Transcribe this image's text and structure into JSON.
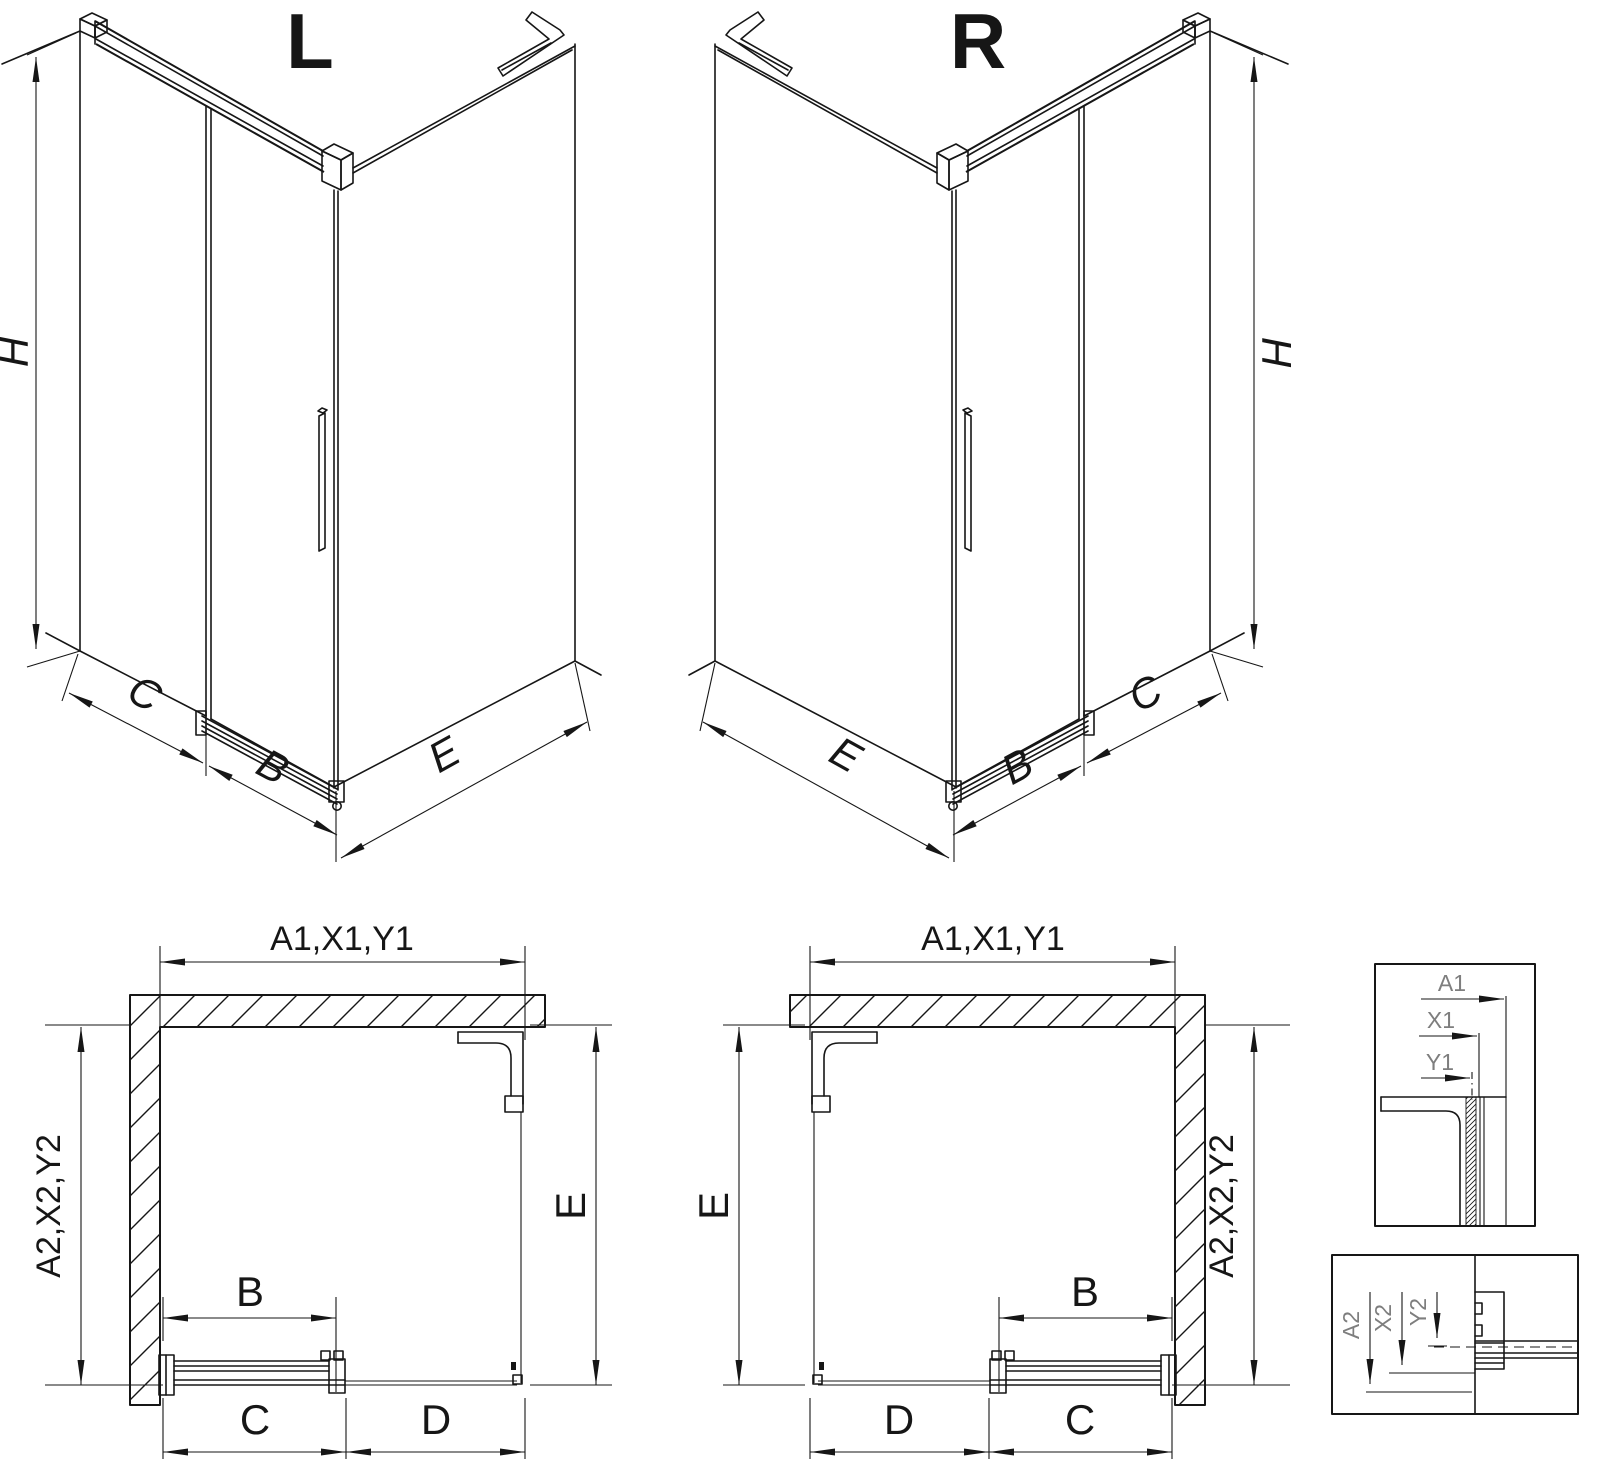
{
  "drawing": {
    "iso_left": {
      "title": "L",
      "height": "H",
      "segment_back": "C",
      "segment_door": "B",
      "segment_side": "E"
    },
    "iso_right": {
      "title": "R",
      "height": "H",
      "segment_back": "C",
      "segment_door": "B",
      "segment_side": "E"
    },
    "plan_left": {
      "width": "A1,X1,Y1",
      "depth": "A2,X2,Y2",
      "side": "E",
      "door": "B",
      "run": "C",
      "opening": "D"
    },
    "plan_right": {
      "width": "A1,X1,Y1",
      "depth": "A2,X2,Y2",
      "side": "E",
      "door": "B",
      "run": "C",
      "opening": "D"
    },
    "detail_top": {
      "a": "A1",
      "x": "X1",
      "y": "Y1"
    },
    "detail_bottom": {
      "a": "A2",
      "x": "X2",
      "y": "Y2"
    }
  },
  "colors": {
    "line": "#161616",
    "detail_label": "#7e7e7e",
    "background": "#ffffff"
  }
}
